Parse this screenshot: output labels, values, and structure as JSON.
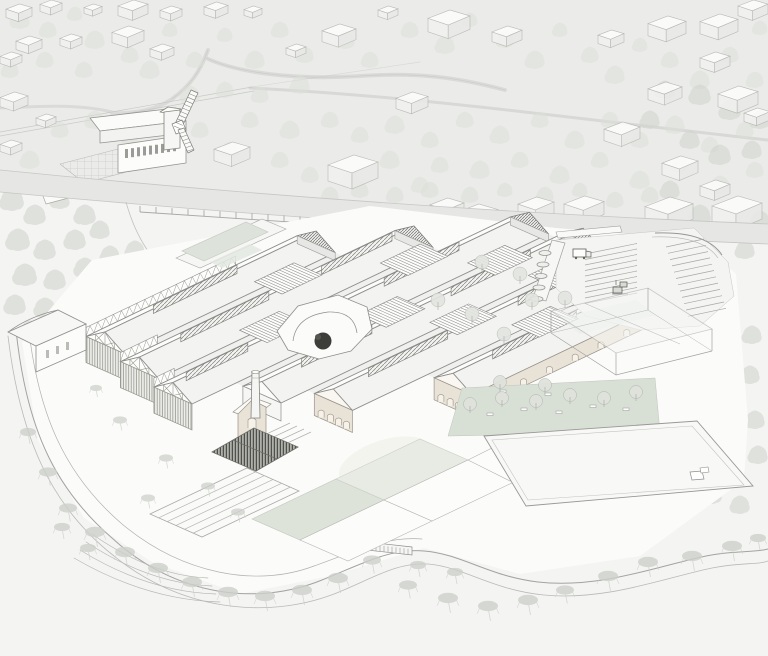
{
  "illustration": {
    "kind": "architectural-aerial-axonometric-site-rendering",
    "subject": "factory-complex-with-sawtooth-halls"
  },
  "palette": {
    "paper": "#f4f4f3",
    "wash": "#ebecea",
    "band": "#e6e7e5",
    "line": "#8d8e8a",
    "lineMid": "#a8a9a5",
    "lineFaint": "#c5c6c2",
    "roofLight": "#fcfcfb",
    "roofShade": "#f3f3f1",
    "valley": "#f0f0ee",
    "apron": "#fbfbfa",
    "timberLine": "#96978f",
    "brick": "#e9e2d6",
    "brickLine": "#9b9389",
    "sage": "#dde3d9",
    "sagePale": "#e8ece5",
    "lawn": "#d8dfd5",
    "tree": "#dcdfd8",
    "treeDark": "#d2d6cf",
    "wisp": "#cdd1ca",
    "darkTree": "#3d3e39",
    "glassLine": "#a2a3a0",
    "combDark": "#7b7c76"
  },
  "scene": {
    "projection": {
      "a": 0.88,
      "b": -0.42,
      "c": 0.865,
      "d": 0.385,
      "e": 105,
      "f": 345
    },
    "halls": [
      {
        "id": "hall-a",
        "vc": 0,
        "u0": 0,
        "u1": 240,
        "sw": "truss",
        "wallH": 26,
        "monitors": [
          [
            55,
            150
          ]
        ],
        "nwTruss": [
          0,
          170
        ]
      },
      {
        "id": "hall-b",
        "vc": 52,
        "u0": -12,
        "u1": 300,
        "sw": "truss",
        "wallH": 26,
        "monitors": [
          [
            35,
            135
          ],
          [
            195,
            275
          ]
        ],
        "nwTruss": [
          -12,
          30
        ]
      },
      {
        "id": "hall-c",
        "vc": 104,
        "u0": -25,
        "u1": 380,
        "sw": "truss",
        "wallH": 26,
        "monitors": [
          [
            -10,
            60
          ],
          [
            215,
            300
          ]
        ],
        "nwTruss": [
          -25,
          -2
        ]
      },
      {
        "id": "hall-d",
        "vc": 156,
        "u0": 25,
        "u1": 390,
        "sw": "plain",
        "wallH": 18,
        "monitors": [
          [
            70,
            150
          ],
          [
            240,
            330
          ]
        ]
      },
      {
        "id": "hall-e",
        "vc": 208,
        "u0": 55,
        "u1": 400,
        "sw": "brick",
        "wallH": 22,
        "monitors": [
          [
            95,
            185
          ],
          [
            265,
            350
          ]
        ]
      },
      {
        "id": "hall-f",
        "vc": 260,
        "u0": 140,
        "u1": 345,
        "sw": "brick",
        "wallH": 22,
        "monitors": [
          [
            185,
            280
          ]
        ],
        "seWall": {
          "h": 16,
          "arches": 6
        }
      }
    ],
    "stairs": [
      [
        160,
        205,
        0
      ],
      [
        92,
        137,
        1
      ],
      [
        252,
        297,
        1
      ],
      [
        176,
        220,
        2
      ],
      [
        300,
        342,
        2
      ],
      [
        206,
        250,
        3
      ],
      [
        318,
        356,
        3
      ],
      [
        248,
        292,
        4
      ]
    ],
    "trees": {
      "background": [
        [
          20,
          20,
          9
        ],
        [
          48,
          30,
          8
        ],
        [
          75,
          14,
          7
        ],
        [
          95,
          40,
          9
        ],
        [
          130,
          55,
          8
        ],
        [
          170,
          30,
          7
        ],
        [
          150,
          70,
          9
        ],
        [
          195,
          60,
          8
        ],
        [
          225,
          35,
          7
        ],
        [
          255,
          60,
          9
        ],
        [
          280,
          30,
          8
        ],
        [
          305,
          55,
          8
        ],
        [
          345,
          40,
          9
        ],
        [
          370,
          60,
          8
        ],
        [
          300,
          85,
          9
        ],
        [
          260,
          95,
          8
        ],
        [
          225,
          90,
          8
        ],
        [
          190,
          95,
          9
        ],
        [
          410,
          30,
          8
        ],
        [
          445,
          45,
          9
        ],
        [
          470,
          20,
          7
        ],
        [
          505,
          40,
          8
        ],
        [
          535,
          60,
          9
        ],
        [
          560,
          30,
          7
        ],
        [
          590,
          55,
          8
        ],
        [
          615,
          75,
          9
        ],
        [
          640,
          45,
          7
        ],
        [
          670,
          60,
          8
        ],
        [
          700,
          80,
          9
        ],
        [
          730,
          55,
          8
        ],
        [
          755,
          80,
          8
        ],
        [
          760,
          28,
          7
        ],
        [
          84,
          70,
          8
        ],
        [
          45,
          60,
          8
        ],
        [
          10,
          70,
          8
        ],
        [
          95,
          120,
          9
        ],
        [
          60,
          130,
          8
        ],
        [
          30,
          160,
          9
        ],
        [
          130,
          140,
          8
        ],
        [
          250,
          120,
          8
        ],
        [
          290,
          130,
          9
        ],
        [
          330,
          120,
          8
        ],
        [
          360,
          135,
          8
        ],
        [
          395,
          125,
          9
        ],
        [
          430,
          140,
          8
        ],
        [
          465,
          120,
          8
        ],
        [
          500,
          135,
          9
        ],
        [
          540,
          120,
          8
        ],
        [
          575,
          140,
          9
        ],
        [
          610,
          120,
          8
        ],
        [
          640,
          140,
          8
        ],
        [
          675,
          125,
          9
        ],
        [
          710,
          145,
          8
        ],
        [
          745,
          130,
          8
        ],
        [
          390,
          160,
          9
        ],
        [
          440,
          165,
          8
        ],
        [
          480,
          170,
          9
        ],
        [
          520,
          160,
          8
        ],
        [
          560,
          175,
          9
        ],
        [
          600,
          160,
          8
        ],
        [
          640,
          180,
          9
        ],
        [
          680,
          165,
          8
        ],
        [
          720,
          185,
          9
        ],
        [
          755,
          170,
          8
        ],
        [
          280,
          160,
          8
        ],
        [
          310,
          175,
          8
        ],
        [
          200,
          130,
          8
        ],
        [
          165,
          120,
          8
        ],
        [
          230,
          150,
          8
        ],
        [
          350,
          180,
          8
        ],
        [
          420,
          185,
          8
        ]
      ],
      "forest_left": [
        [
          12,
          200,
          11
        ],
        [
          35,
          215,
          10
        ],
        [
          60,
          200,
          9
        ],
        [
          85,
          215,
          10
        ],
        [
          18,
          240,
          11
        ],
        [
          45,
          250,
          10
        ],
        [
          75,
          240,
          10
        ],
        [
          100,
          230,
          9
        ],
        [
          25,
          275,
          11
        ],
        [
          55,
          280,
          10
        ],
        [
          85,
          268,
          10
        ],
        [
          110,
          255,
          9
        ],
        [
          15,
          305,
          10
        ],
        [
          45,
          308,
          10
        ],
        [
          78,
          298,
          10
        ],
        [
          105,
          285,
          9
        ],
        [
          118,
          310,
          9
        ],
        [
          60,
          325,
          9
        ],
        [
          30,
          330,
          9
        ],
        [
          95,
          325,
          8
        ],
        [
          120,
          335,
          8
        ],
        [
          140,
          300,
          9
        ],
        [
          150,
          272,
          9
        ],
        [
          135,
          250,
          9
        ],
        [
          160,
          320,
          8
        ],
        [
          170,
          295,
          8
        ]
      ],
      "forest_right": [
        [
          700,
          95,
          10
        ],
        [
          730,
          110,
          10
        ],
        [
          760,
          120,
          9
        ],
        [
          690,
          140,
          9
        ],
        [
          720,
          155,
          10
        ],
        [
          752,
          150,
          9
        ],
        [
          700,
          215,
          10
        ],
        [
          730,
          230,
          10
        ],
        [
          760,
          220,
          9
        ],
        [
          745,
          250,
          9
        ],
        [
          700,
          330,
          10
        ],
        [
          725,
          345,
          10
        ],
        [
          752,
          335,
          9
        ],
        [
          695,
          370,
          10
        ],
        [
          722,
          385,
          10
        ],
        [
          750,
          375,
          9
        ],
        [
          700,
          415,
          10
        ],
        [
          728,
          430,
          10
        ],
        [
          755,
          420,
          9
        ],
        [
          705,
          460,
          10
        ],
        [
          735,
          470,
          9
        ],
        [
          758,
          455,
          9
        ],
        [
          712,
          495,
          9
        ],
        [
          740,
          505,
          9
        ],
        [
          690,
          300,
          9
        ],
        [
          665,
          90,
          9
        ],
        [
          650,
          120,
          9
        ],
        [
          670,
          190,
          9
        ],
        [
          660,
          230,
          9
        ]
      ],
      "roadside": [
        [
          395,
          195,
          8
        ],
        [
          430,
          190,
          8
        ],
        [
          470,
          195,
          8
        ],
        [
          505,
          190,
          7
        ],
        [
          545,
          195,
          8
        ],
        [
          580,
          190,
          7
        ],
        [
          615,
          200,
          8
        ],
        [
          650,
          195,
          8
        ],
        [
          470,
          230,
          7
        ],
        [
          500,
          240,
          7
        ],
        [
          530,
          225,
          7
        ],
        [
          360,
          190,
          8
        ],
        [
          330,
          195,
          8
        ]
      ],
      "site_singles": [
        [
          438,
          300
        ],
        [
          472,
          314
        ],
        [
          504,
          334
        ],
        [
          532,
          300
        ],
        [
          482,
          262
        ],
        [
          520,
          274
        ],
        [
          565,
          298
        ]
      ],
      "lawn": [
        [
          470,
          404
        ],
        [
          502,
          398
        ],
        [
          536,
          401
        ],
        [
          570,
          395
        ],
        [
          604,
          398
        ],
        [
          636,
          392
        ],
        [
          545,
          385
        ],
        [
          500,
          382
        ]
      ],
      "apron_wisps": [
        [
          120,
          420,
          7
        ],
        [
          166,
          458,
          7
        ],
        [
          208,
          486,
          7
        ],
        [
          96,
          388,
          6
        ],
        [
          148,
          498,
          7
        ],
        [
          238,
          512,
          7
        ]
      ],
      "bank_wisps": [
        [
          28,
          432,
          8
        ],
        [
          48,
          472,
          9
        ],
        [
          68,
          508,
          9
        ],
        [
          95,
          532,
          10
        ],
        [
          125,
          552,
          10
        ],
        [
          158,
          568,
          10
        ],
        [
          192,
          582,
          10
        ],
        [
          228,
          592,
          10
        ],
        [
          265,
          596,
          10
        ],
        [
          302,
          590,
          10
        ],
        [
          338,
          578,
          10
        ],
        [
          372,
          560,
          9
        ],
        [
          408,
          585,
          9
        ],
        [
          448,
          598,
          10
        ],
        [
          488,
          606,
          10
        ],
        [
          528,
          600,
          10
        ],
        [
          565,
          590,
          9
        ],
        [
          608,
          576,
          10
        ],
        [
          648,
          562,
          10
        ],
        [
          692,
          556,
          10
        ],
        [
          732,
          546,
          10
        ],
        [
          758,
          538,
          8
        ],
        [
          418,
          565,
          8
        ],
        [
          455,
          572,
          8
        ],
        [
          62,
          527,
          8
        ],
        [
          88,
          548,
          8
        ]
      ]
    },
    "bg_buildings": [
      [
        6,
        4,
        26
      ],
      [
        40,
        0,
        22
      ],
      [
        84,
        4,
        18
      ],
      [
        118,
        0,
        30
      ],
      [
        160,
        6,
        22
      ],
      [
        204,
        2,
        24
      ],
      [
        244,
        6,
        18
      ],
      [
        322,
        24,
        34
      ],
      [
        112,
        26,
        32
      ],
      [
        60,
        34,
        22
      ],
      [
        16,
        36,
        26
      ],
      [
        0,
        52,
        22
      ],
      [
        150,
        44,
        24
      ],
      [
        286,
        44,
        20
      ],
      [
        378,
        6,
        20
      ],
      [
        428,
        10,
        42
      ],
      [
        492,
        26,
        30
      ],
      [
        598,
        30,
        26
      ],
      [
        648,
        16,
        38
      ],
      [
        700,
        14,
        38
      ],
      [
        738,
        0,
        30
      ],
      [
        648,
        82,
        34
      ],
      [
        700,
        52,
        30
      ],
      [
        718,
        86,
        40
      ],
      [
        744,
        108,
        26
      ],
      [
        604,
        122,
        36
      ],
      [
        662,
        156,
        36
      ],
      [
        700,
        180,
        30
      ],
      [
        0,
        92,
        28
      ],
      [
        36,
        114,
        20
      ],
      [
        396,
        92,
        32
      ],
      [
        143,
        116,
        18
      ],
      [
        214,
        142,
        36
      ],
      [
        328,
        155,
        50
      ],
      [
        430,
        198,
        34
      ],
      [
        458,
        204,
        40
      ],
      [
        0,
        140,
        22
      ],
      [
        518,
        197,
        36
      ],
      [
        564,
        196,
        40
      ],
      [
        645,
        197,
        48
      ],
      [
        712,
        196,
        50
      ]
    ],
    "wall_posts": {
      "x0": 140,
      "x1": 540,
      "step": 16,
      "y0": 212,
      "slope": 0.065,
      "height": 6
    },
    "parking": {
      "stripes_center": {
        "x": 585,
        "y": 254,
        "len_dx": 52,
        "len_dy": -10.5,
        "step_dy": 5.5,
        "count": 10
      },
      "stripes_right": {
        "x": 666,
        "y": 247,
        "len_dx": 38,
        "len_dy": -8,
        "step_dx": 2,
        "step_dy": 6.3,
        "count": 12
      }
    },
    "skylight_ovals": {
      "cx": 545,
      "cy": 253,
      "dx": -2,
      "dy": 11.5,
      "rx": 6,
      "ry": 2.5,
      "count": 5
    },
    "benches": [
      [
        487,
        413
      ],
      [
        521,
        408
      ],
      [
        556,
        411
      ],
      [
        590,
        405
      ],
      [
        623,
        408
      ],
      [
        545,
        393
      ],
      [
        500,
        390
      ]
    ],
    "colonnade_comb": {
      "x0": 125,
      "y0": 149,
      "dx": 6,
      "dy": -0.85,
      "n": 9,
      "w": 3,
      "h": 9
    }
  }
}
